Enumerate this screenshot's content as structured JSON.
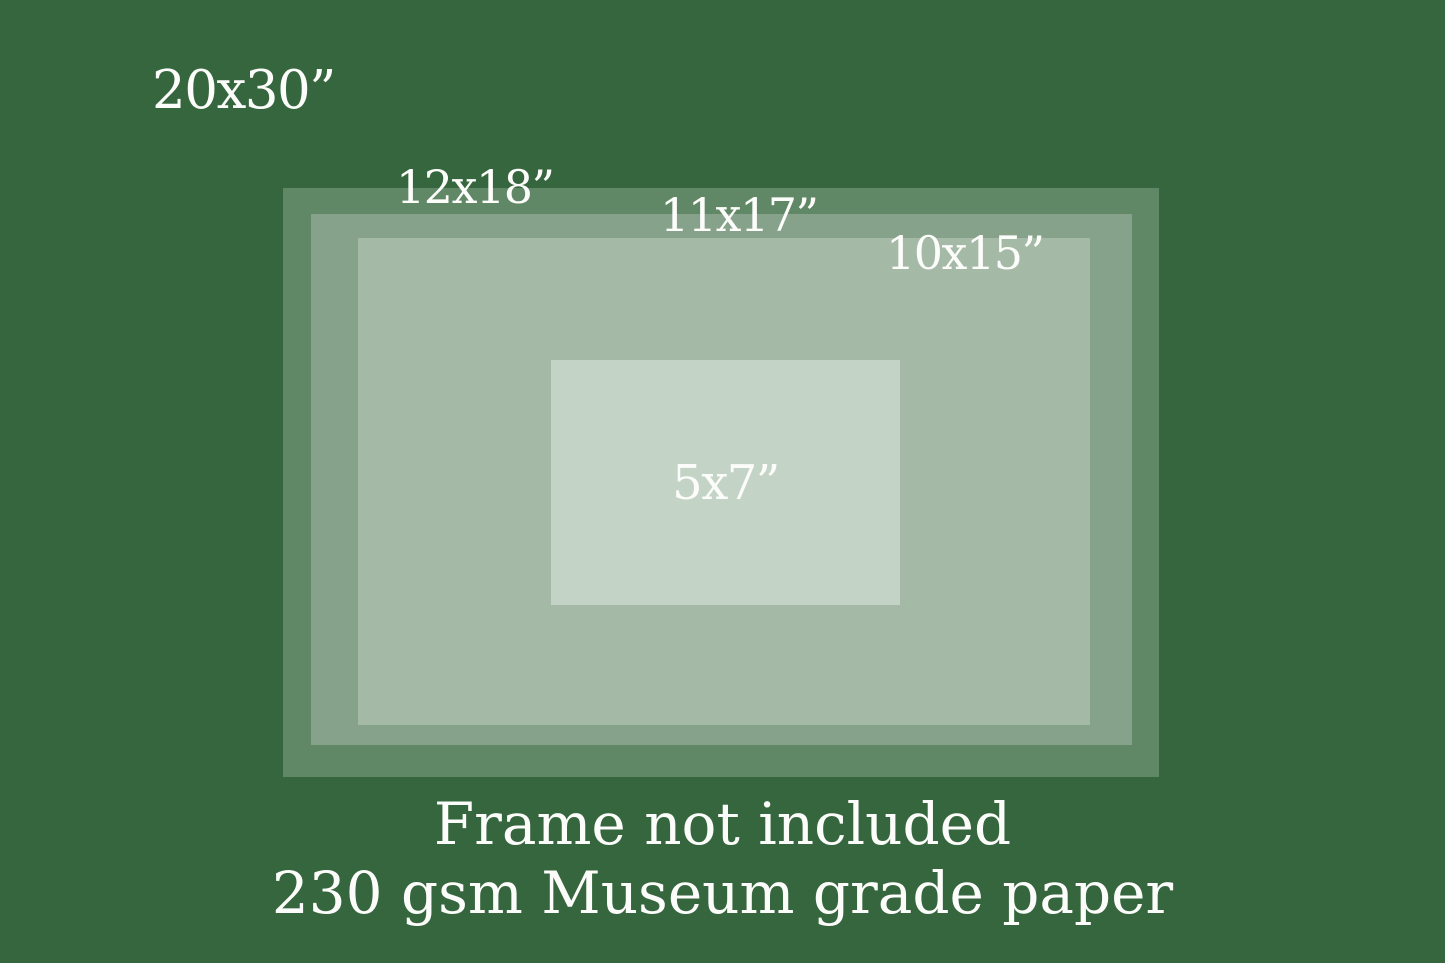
{
  "chart": {
    "background_color": "#35663D",
    "text_color": "#FCFCFA",
    "print_sizes": [
      {
        "label": "20x30”",
        "color": "#35663D"
      },
      {
        "label": "12x18”",
        "color": "#618866"
      },
      {
        "label": "11x17”",
        "color": "#86A28A"
      },
      {
        "label": "10x15”",
        "color": "#A4B9A6"
      },
      {
        "label": "5x7”",
        "color": "#C3D3C5"
      }
    ],
    "footer": {
      "line1": "Frame not included",
      "line2": "230 gsm Museum grade paper"
    }
  }
}
